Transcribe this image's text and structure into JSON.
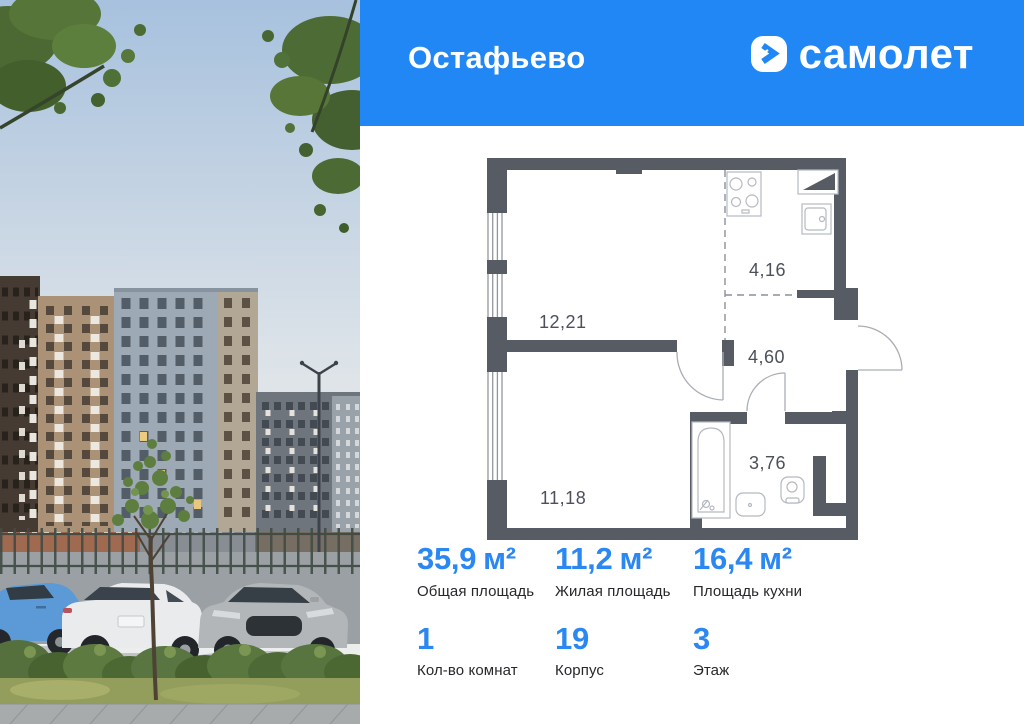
{
  "header": {
    "project_name": "Остафьево",
    "brand_name": "самолет"
  },
  "floor_plan": {
    "room_areas": {
      "room_main": "12,21",
      "kitchen_zone": "4,16",
      "hallway": "4,60",
      "bathroom": "3,76",
      "room_lower": "11,18"
    }
  },
  "stats": [
    {
      "value": "35,9",
      "unit": "м²",
      "label": "Общая площадь"
    },
    {
      "value": "11,2",
      "unit": "м²",
      "label": "Жилая площадь"
    },
    {
      "value": "16,4",
      "unit": "м²",
      "label": "Площадь кухни"
    },
    {
      "value": "1",
      "unit": "",
      "label": "Кол-во комнат"
    },
    {
      "value": "19",
      "unit": "",
      "label": "Корпус"
    },
    {
      "value": "3",
      "unit": "",
      "label": "Этаж"
    }
  ],
  "colors": {
    "header_blue": "#2187f5",
    "stat_value_blue": "#2b87f2",
    "plan_wall_gray": "#565b64"
  }
}
